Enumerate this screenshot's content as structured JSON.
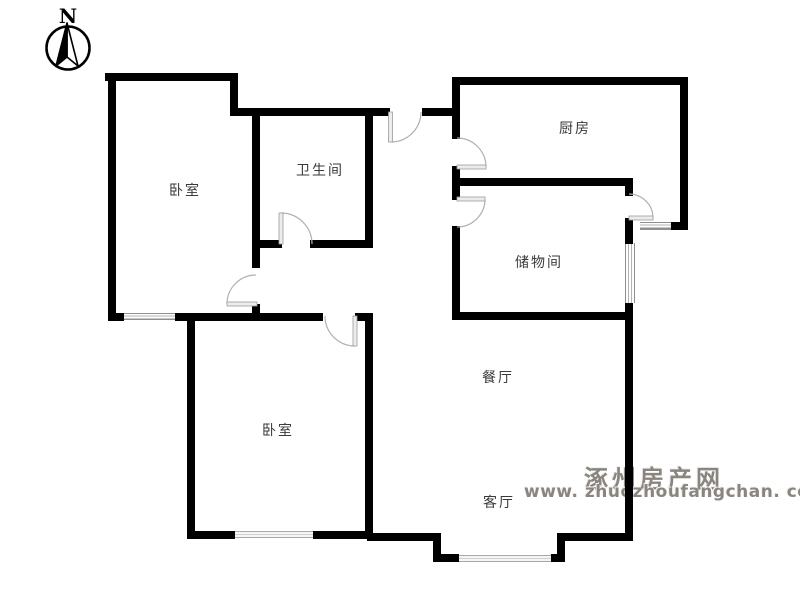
{
  "compass": {
    "label": "N"
  },
  "rooms": [
    {
      "id": "bedroom-nw",
      "label": "卧室"
    },
    {
      "id": "bathroom",
      "label": "卫生间"
    },
    {
      "id": "kitchen",
      "label": "厨房"
    },
    {
      "id": "storage",
      "label": "储物间"
    },
    {
      "id": "dining",
      "label": "餐厅"
    },
    {
      "id": "bedroom-sw",
      "label": "卧室"
    },
    {
      "id": "living",
      "label": "客厅"
    }
  ],
  "watermark": {
    "site_name": "涿州房产网",
    "site_url": "www. zhuozhoufangchan. com"
  },
  "colors": {
    "wall": "#000000",
    "door": "#b0b0b0",
    "window": "#8f8f8f",
    "label_text": "#3a3a3a",
    "watermark_text": "#8a857f"
  }
}
